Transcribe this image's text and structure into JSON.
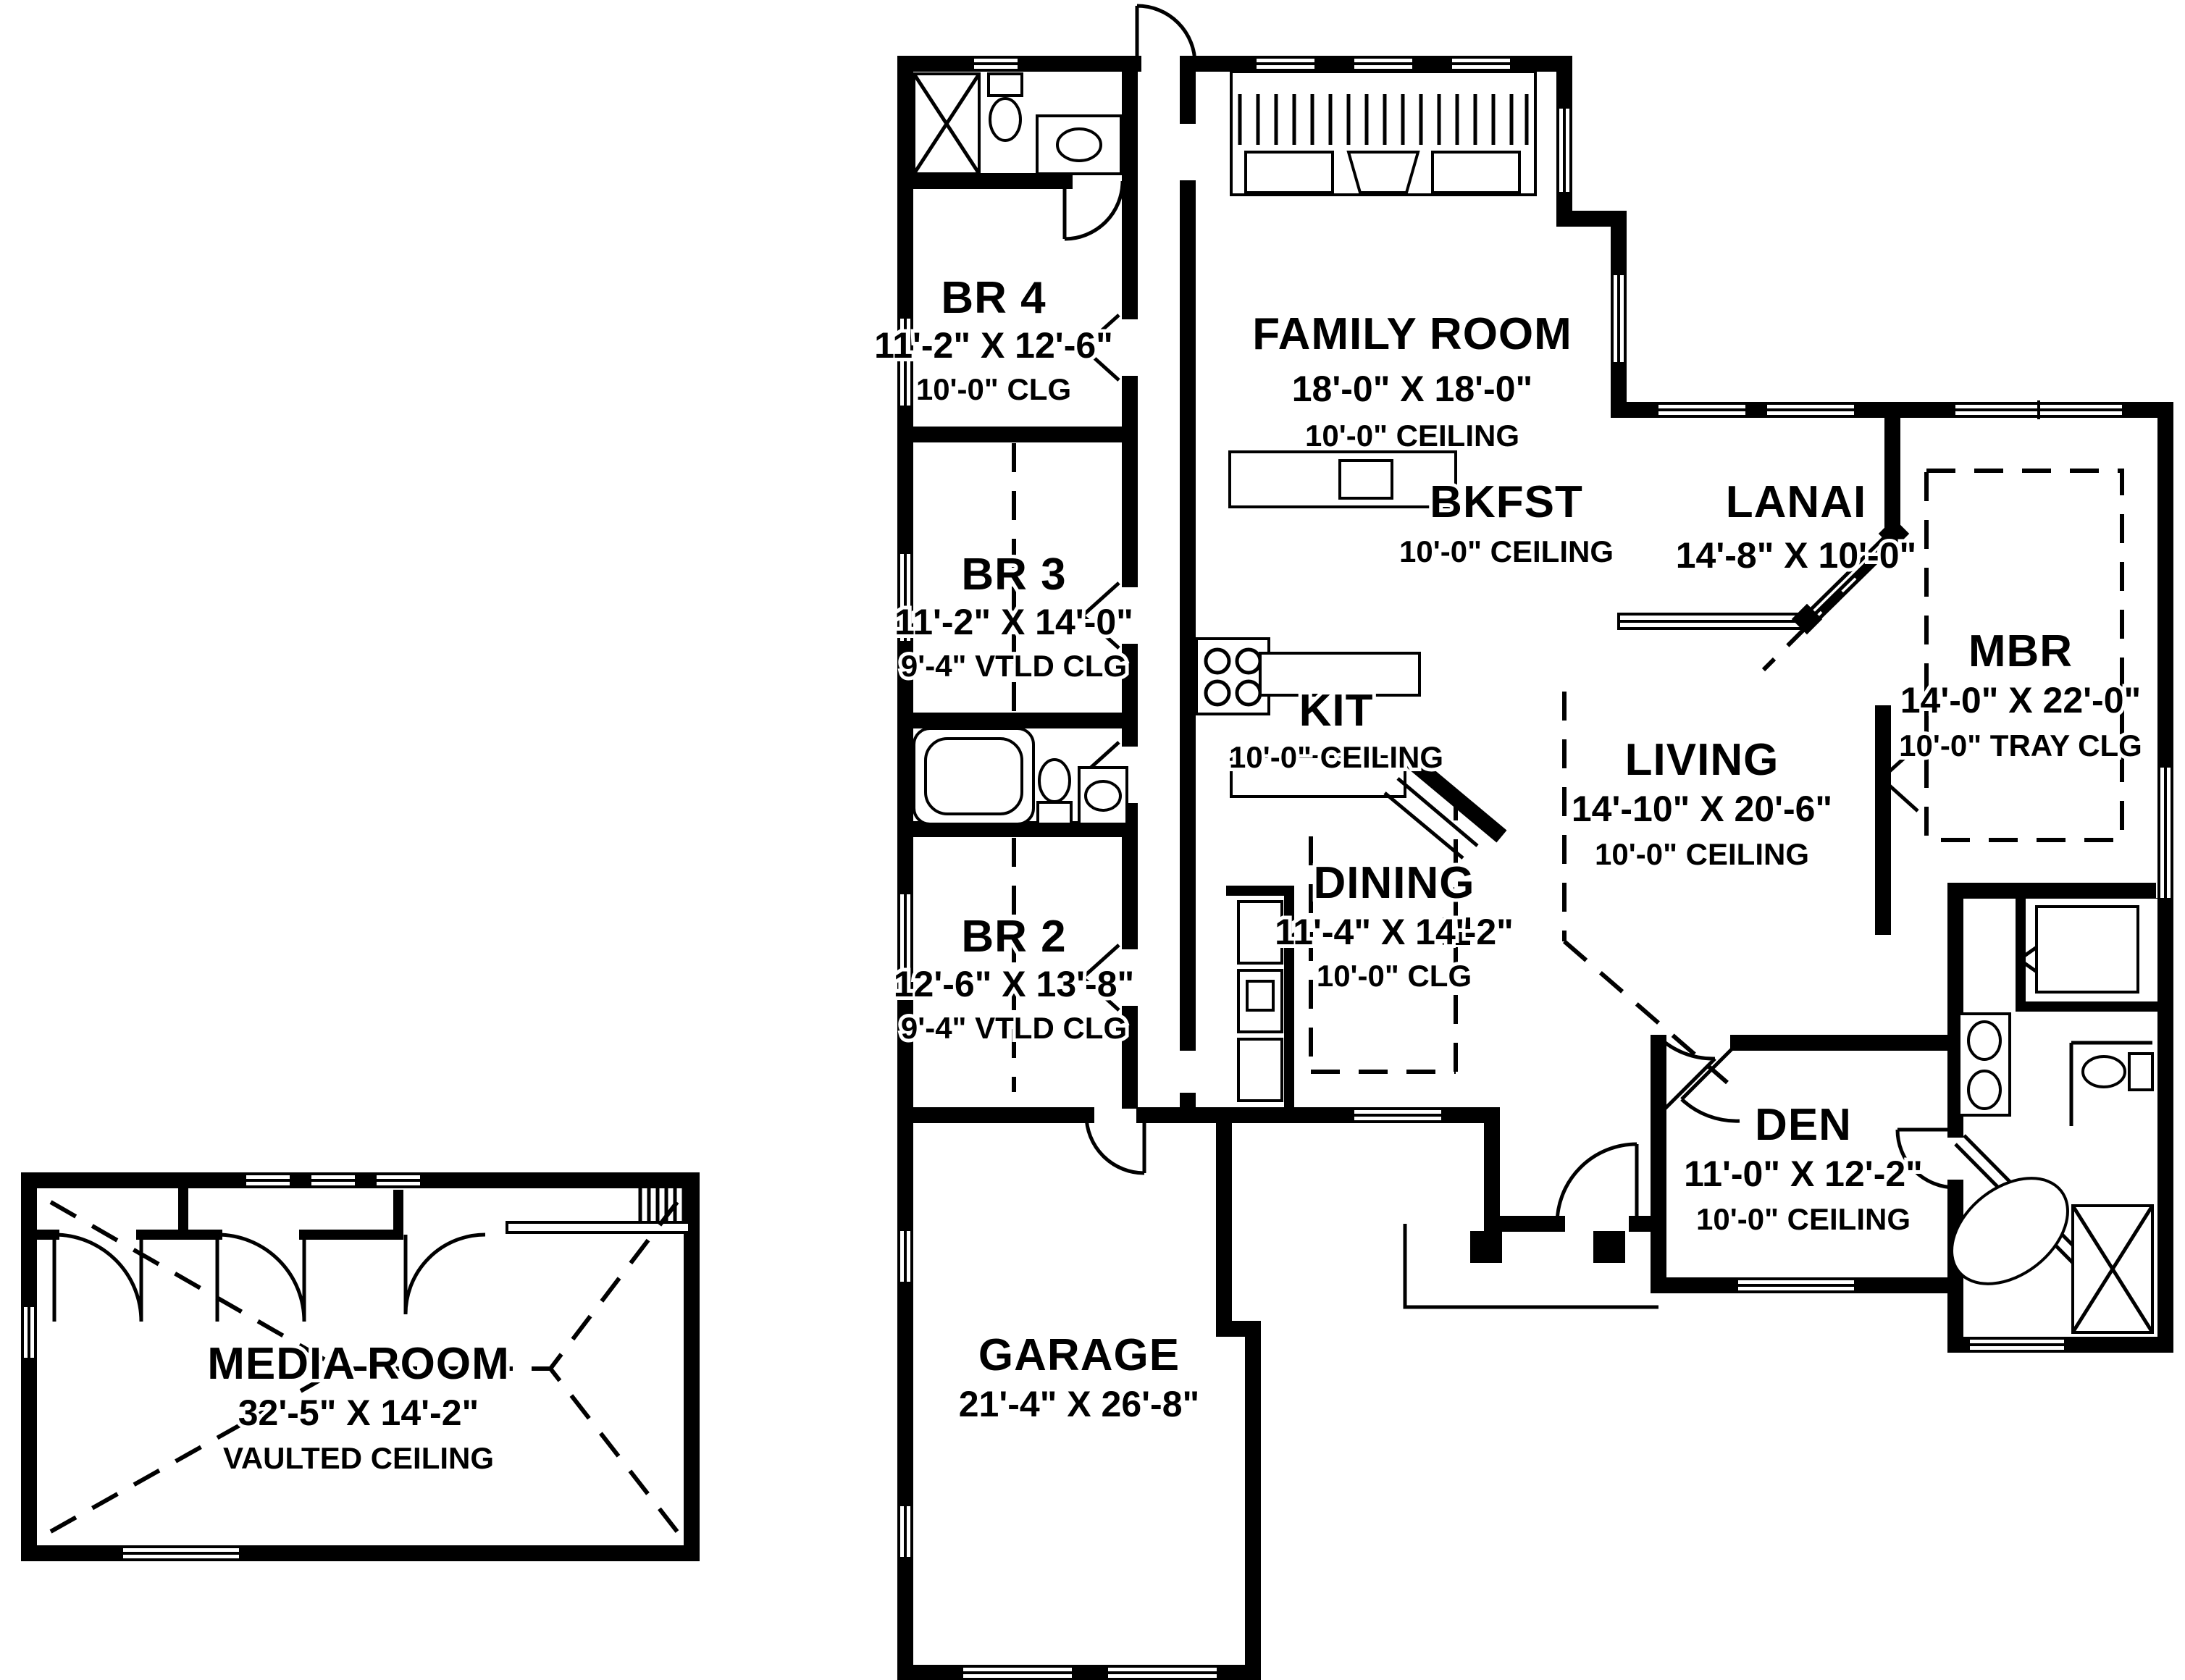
{
  "plan": {
    "type": "single_story_floor_plan",
    "colors": {
      "walls": "#000000",
      "background": "#ffffff"
    },
    "rooms": {
      "br4": {
        "name": "BR 4",
        "dims": "11'-2\" X 12'-6\"",
        "ceiling": "10'-0\" CLG"
      },
      "family": {
        "name": "FAMILY ROOM",
        "dims": "18'-0\" X 18'-0\"",
        "ceiling": "10'-0\" CEILING"
      },
      "bkfst": {
        "name": "BKFST",
        "dims": "",
        "ceiling": "10'-0\" CEILING"
      },
      "lanai": {
        "name": "LANAI",
        "dims": "14'-8\" X 10'-0\"",
        "ceiling": ""
      },
      "br3": {
        "name": "BR 3",
        "dims": "11'-2\" X 14'-0\"",
        "ceiling": "9'-4\" VTLD CLG"
      },
      "mbr": {
        "name": "MBR",
        "dims": "14'-0\" X 22'-0\"",
        "ceiling": "10'-0\" TRAY CLG"
      },
      "kit": {
        "name": "KIT",
        "dims": "",
        "ceiling": "10'-0\" CEILING"
      },
      "living": {
        "name": "LIVING",
        "dims": "14'-10\" X 20'-6\"",
        "ceiling": "10'-0\" CEILING"
      },
      "dining": {
        "name": "DINING",
        "dims": "11'-4\" X 14'-2\"",
        "ceiling": "10'-0\" CLG"
      },
      "br2": {
        "name": "BR 2",
        "dims": "12'-6\" X 13'-8\"",
        "ceiling": "9'-4\" VTLD CLG"
      },
      "den": {
        "name": "DEN",
        "dims": "11'-0\" X 12'-2\"",
        "ceiling": "10'-0\" CEILING"
      },
      "media": {
        "name": "MEDIA ROOM",
        "dims": "32'-5\" X 14'-2\"",
        "ceiling": "VAULTED CEILING"
      },
      "garage": {
        "name": "GARAGE",
        "dims": "21'-4\" X 26'-8\"",
        "ceiling": ""
      }
    }
  }
}
